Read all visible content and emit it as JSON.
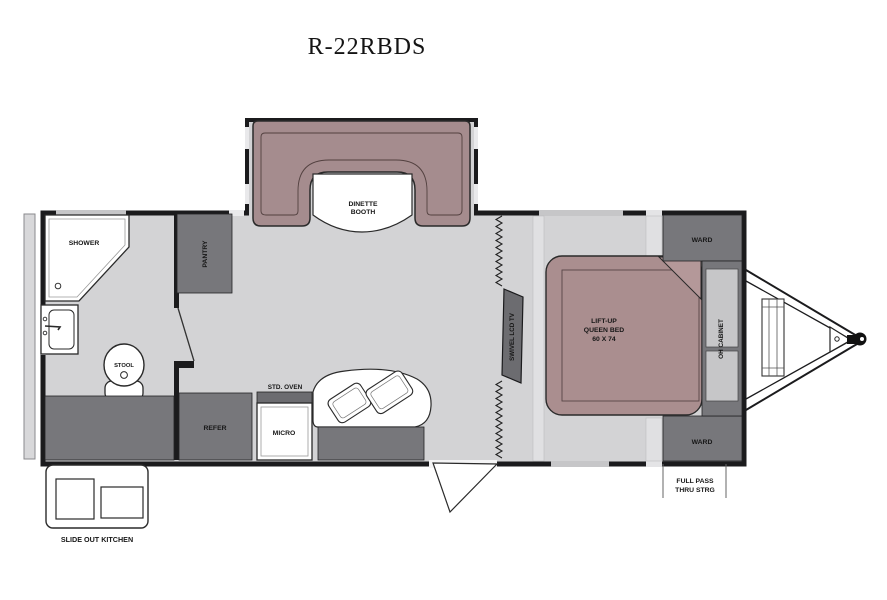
{
  "title": "R-22RBDS",
  "floorplan": {
    "model_name": "R-22RBDS",
    "rooms": {
      "shower": "SHOWER",
      "stool": "STOOL",
      "pantry": "PANTRY",
      "dinette_line1": "DINETTE",
      "dinette_line2": "BOOTH",
      "refer": "REFER",
      "std_oven": "STD. OVEN",
      "micro": "MICRO",
      "swivel_tv": "SWIVEL LCD TV",
      "bed_line1": "LIFT-UP",
      "bed_line2": "QUEEN BED",
      "bed_line3": "60 X 74",
      "ward_top": "WARD",
      "ward_bottom": "WARD",
      "oh_cabinet": "OH CABINET",
      "pass_thru_line1": "FULL PASS",
      "pass_thru_line2": "THRU STRG",
      "slide_out_kitchen": "SLIDE OUT KITCHEN"
    },
    "colors": {
      "floor": "#d3d3d5",
      "cabinet_gray": "#77777b",
      "booth_upholstery": "#a58c8e",
      "bed_upholstery": "#aa8e8f",
      "wall": "#1b1b1d",
      "window": "#c6c6c8",
      "background": "#ffffff"
    }
  }
}
